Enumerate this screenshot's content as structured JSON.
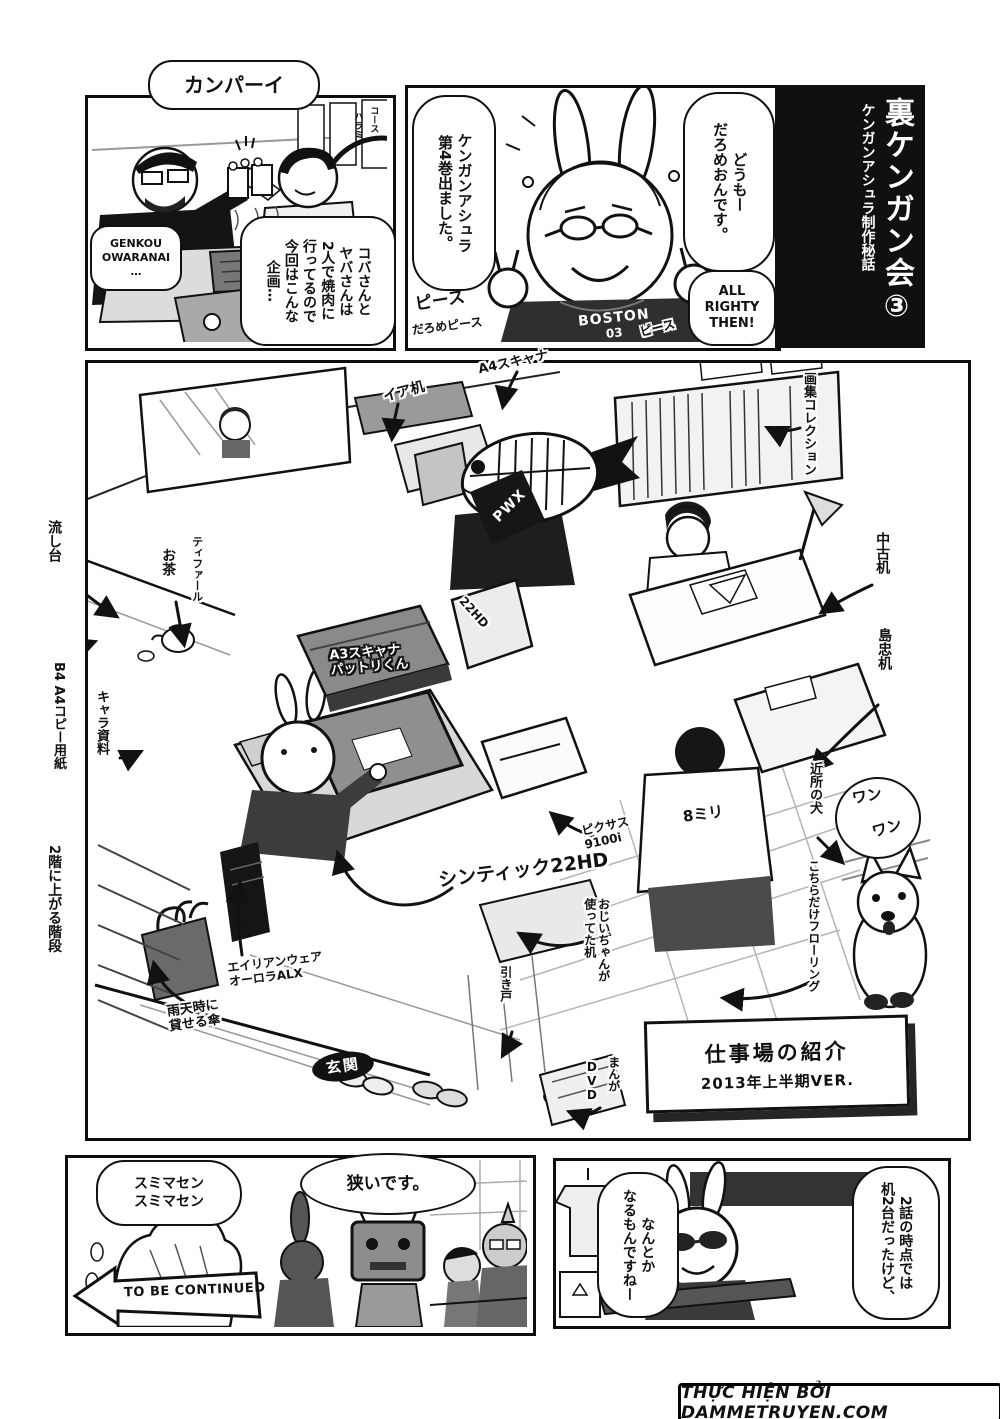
{
  "colors": {
    "ink": "#111111",
    "paper": "#ffffff",
    "tone_gray": "#c8c8c8"
  },
  "header": {
    "title": "裏ケンガン会③",
    "subtitle": "ケンガンアシュラ制作秘話"
  },
  "panel_yakiniku": {
    "kanpai": "カンパーイ",
    "genkou": "GENKOU\nOWARANAI\n…",
    "plan": "コバさんと\nヤバさんは\n2人で焼肉に\n行ってるので\n今回はこんな\n企画…",
    "poster_a": "ハラミ",
    "poster_b": "コース"
  },
  "panel_intro": {
    "volume": "ケンガンアシュラ\n第4巻出ました。",
    "greeting": "どうもー\nだろめおんです。",
    "all_righty": "ALL\nRIGHTY\nTHEN!",
    "peace": "ピース",
    "darome_peace": "だろめピース",
    "shirt_line1": "BOSTON",
    "shirt_line2": "03",
    "shirt_peace": "ピース"
  },
  "workspace": {
    "sign_line1": "仕事場の紹介",
    "sign_line2": "2013年上半期VER.",
    "labels": {
      "a4_scanner": "A4スキャナ",
      "ea_desk": "イア机",
      "art_collection": "画集コレクション",
      "used_desk": "中古机",
      "shimachu_desk": "島忠机",
      "neighbor_dog": "近所の犬",
      "woof1": "ワン",
      "woof2": "ワン",
      "flooring": "こちらだけフローリング",
      "shirt_8mm": "8ミリ",
      "pixus": "ピクサス\n9100i",
      "cintiq": "シンティック22HD",
      "a3_scanner": "A3スキャナ\nパットリくん",
      "monitor_22hd": "22HD",
      "grandpa_desk": "おじいちゃんが\n使ってた机",
      "sliding_door": "引き戸",
      "manga": "まんが",
      "dvd": "DVD",
      "alienware": "エイリアンウェア\nオーロラALX",
      "umbrella": "雨天時に\n貸せる傘",
      "entrance": "玄関",
      "stairs": "2階に上がる階段",
      "copy_paper": "B4 A4コピー用紙",
      "sink": "流し台",
      "tea": "お茶",
      "tfal": "ティファール",
      "char_ref": "キャラ資料",
      "pwx": "PWX"
    }
  },
  "panel_cramped": {
    "sumimasen": "スミマセン\nスミマセン",
    "narrow": "狭いです。",
    "to_be_continued": "TO BE CONTINUED"
  },
  "panel_closing": {
    "left_bubble": "なんとか\nなるもんですねー",
    "right_bubble": "2話の時点では\n机2台だったけど、"
  },
  "footer": {
    "credit": "THỰC HIỆN BỞI DAMMETRUYEN.COM"
  }
}
